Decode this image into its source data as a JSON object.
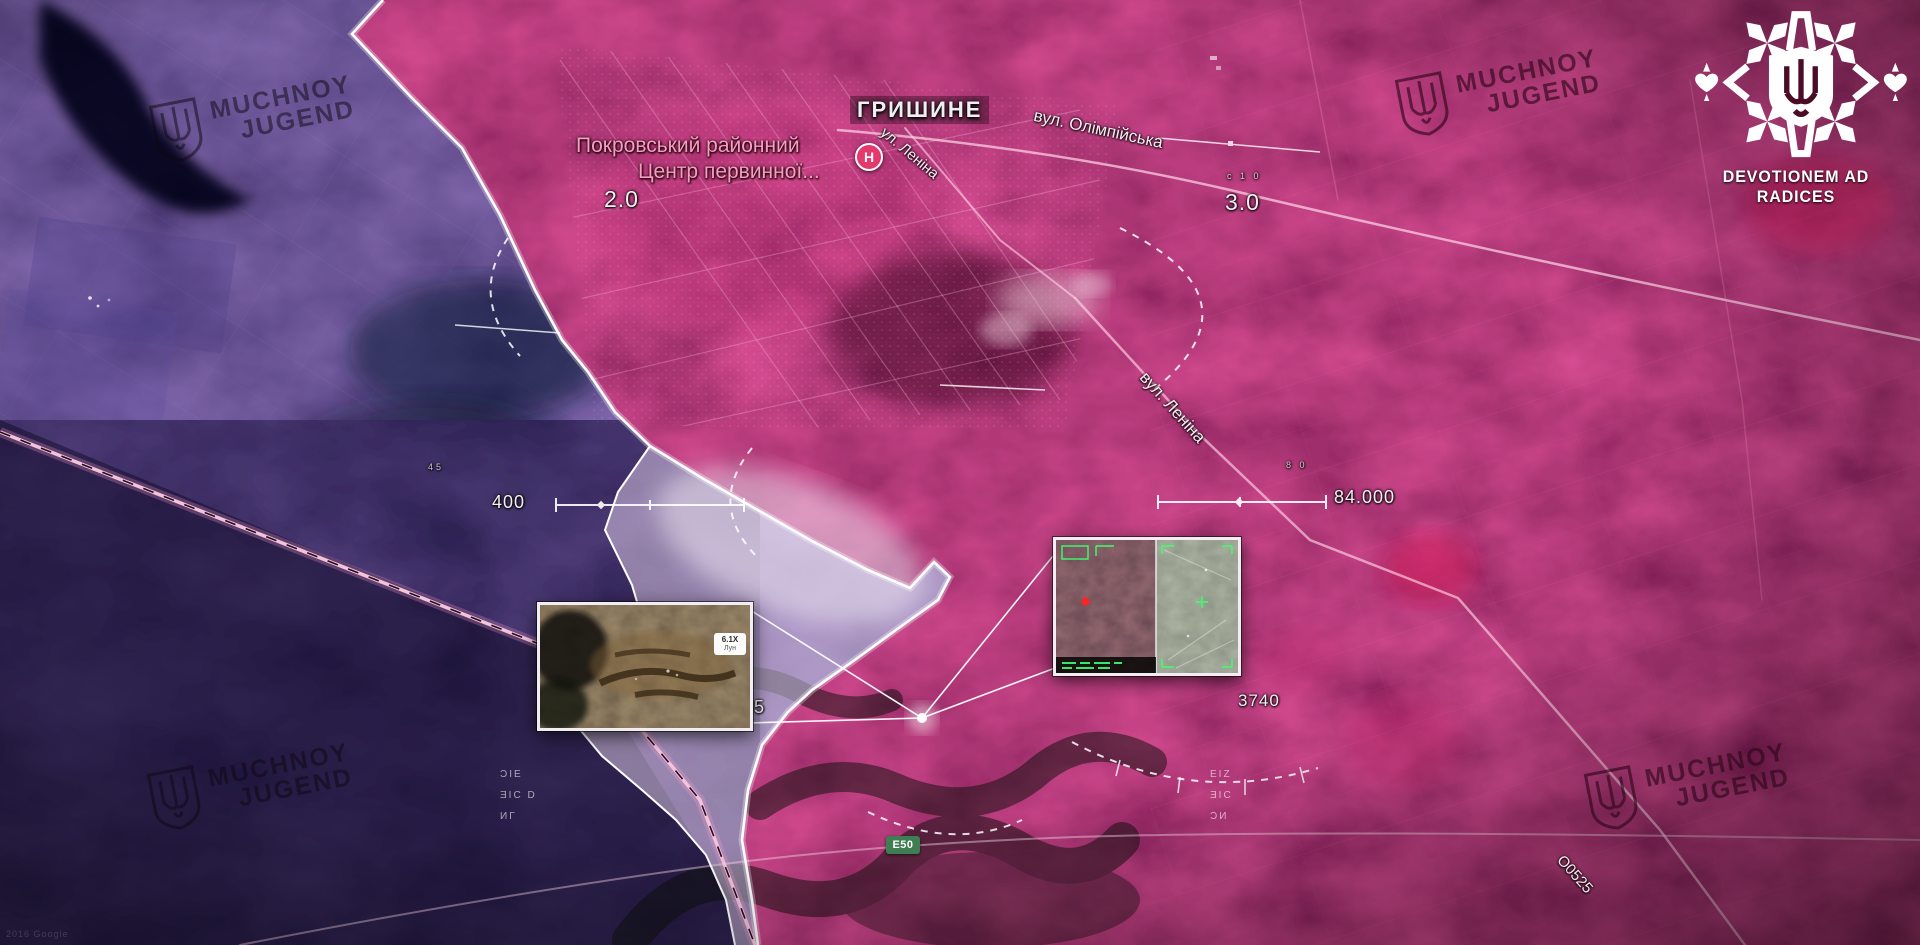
{
  "colors": {
    "crimson_zone": "#8f0d3e",
    "indigo_zone": "#231a52",
    "lavender_zone": "#ead9f2",
    "hospital_pink": "#e5386d",
    "route_green": "#3f7d52"
  },
  "branding": {
    "motto": "DEVOTIONEM AD RADICES",
    "watermark_line1": "MUCHNOY",
    "watermark_line2": "JUGEND"
  },
  "attribution": "2016 Google",
  "map": {
    "town": "ГРИШИНЕ",
    "poi_line1": "Покровський районний",
    "poi_line2": "Центр первинної...",
    "poi_marker": "Н",
    "street_olimpiyska": "вул. Олімпійська",
    "street_lenina_small": "ул. Леніна",
    "street_lenina_main": "вул. Леніна",
    "route_badge": "Е50",
    "route_right": "О0525",
    "m_left_frontage": "2.0",
    "m_right_frontage": "3.0",
    "m_scale_left": "400",
    "m_scale_right": "84.000",
    "m_bottom_left": "0.35",
    "m_bottom_right": "3740",
    "micro_sto": "с 1 0",
    "micro_45": "45",
    "micro_80": "8 0",
    "stack_left": [
      "ϽΙΕ",
      "ƎΙС D",
      "ИГ"
    ],
    "stack_right": [
      "ΕΙΖ",
      "ƎΙС",
      "ƆИ"
    ]
  },
  "insets": {
    "left_zoom": "6.1X",
    "left_zoom_sub": "Лун"
  }
}
